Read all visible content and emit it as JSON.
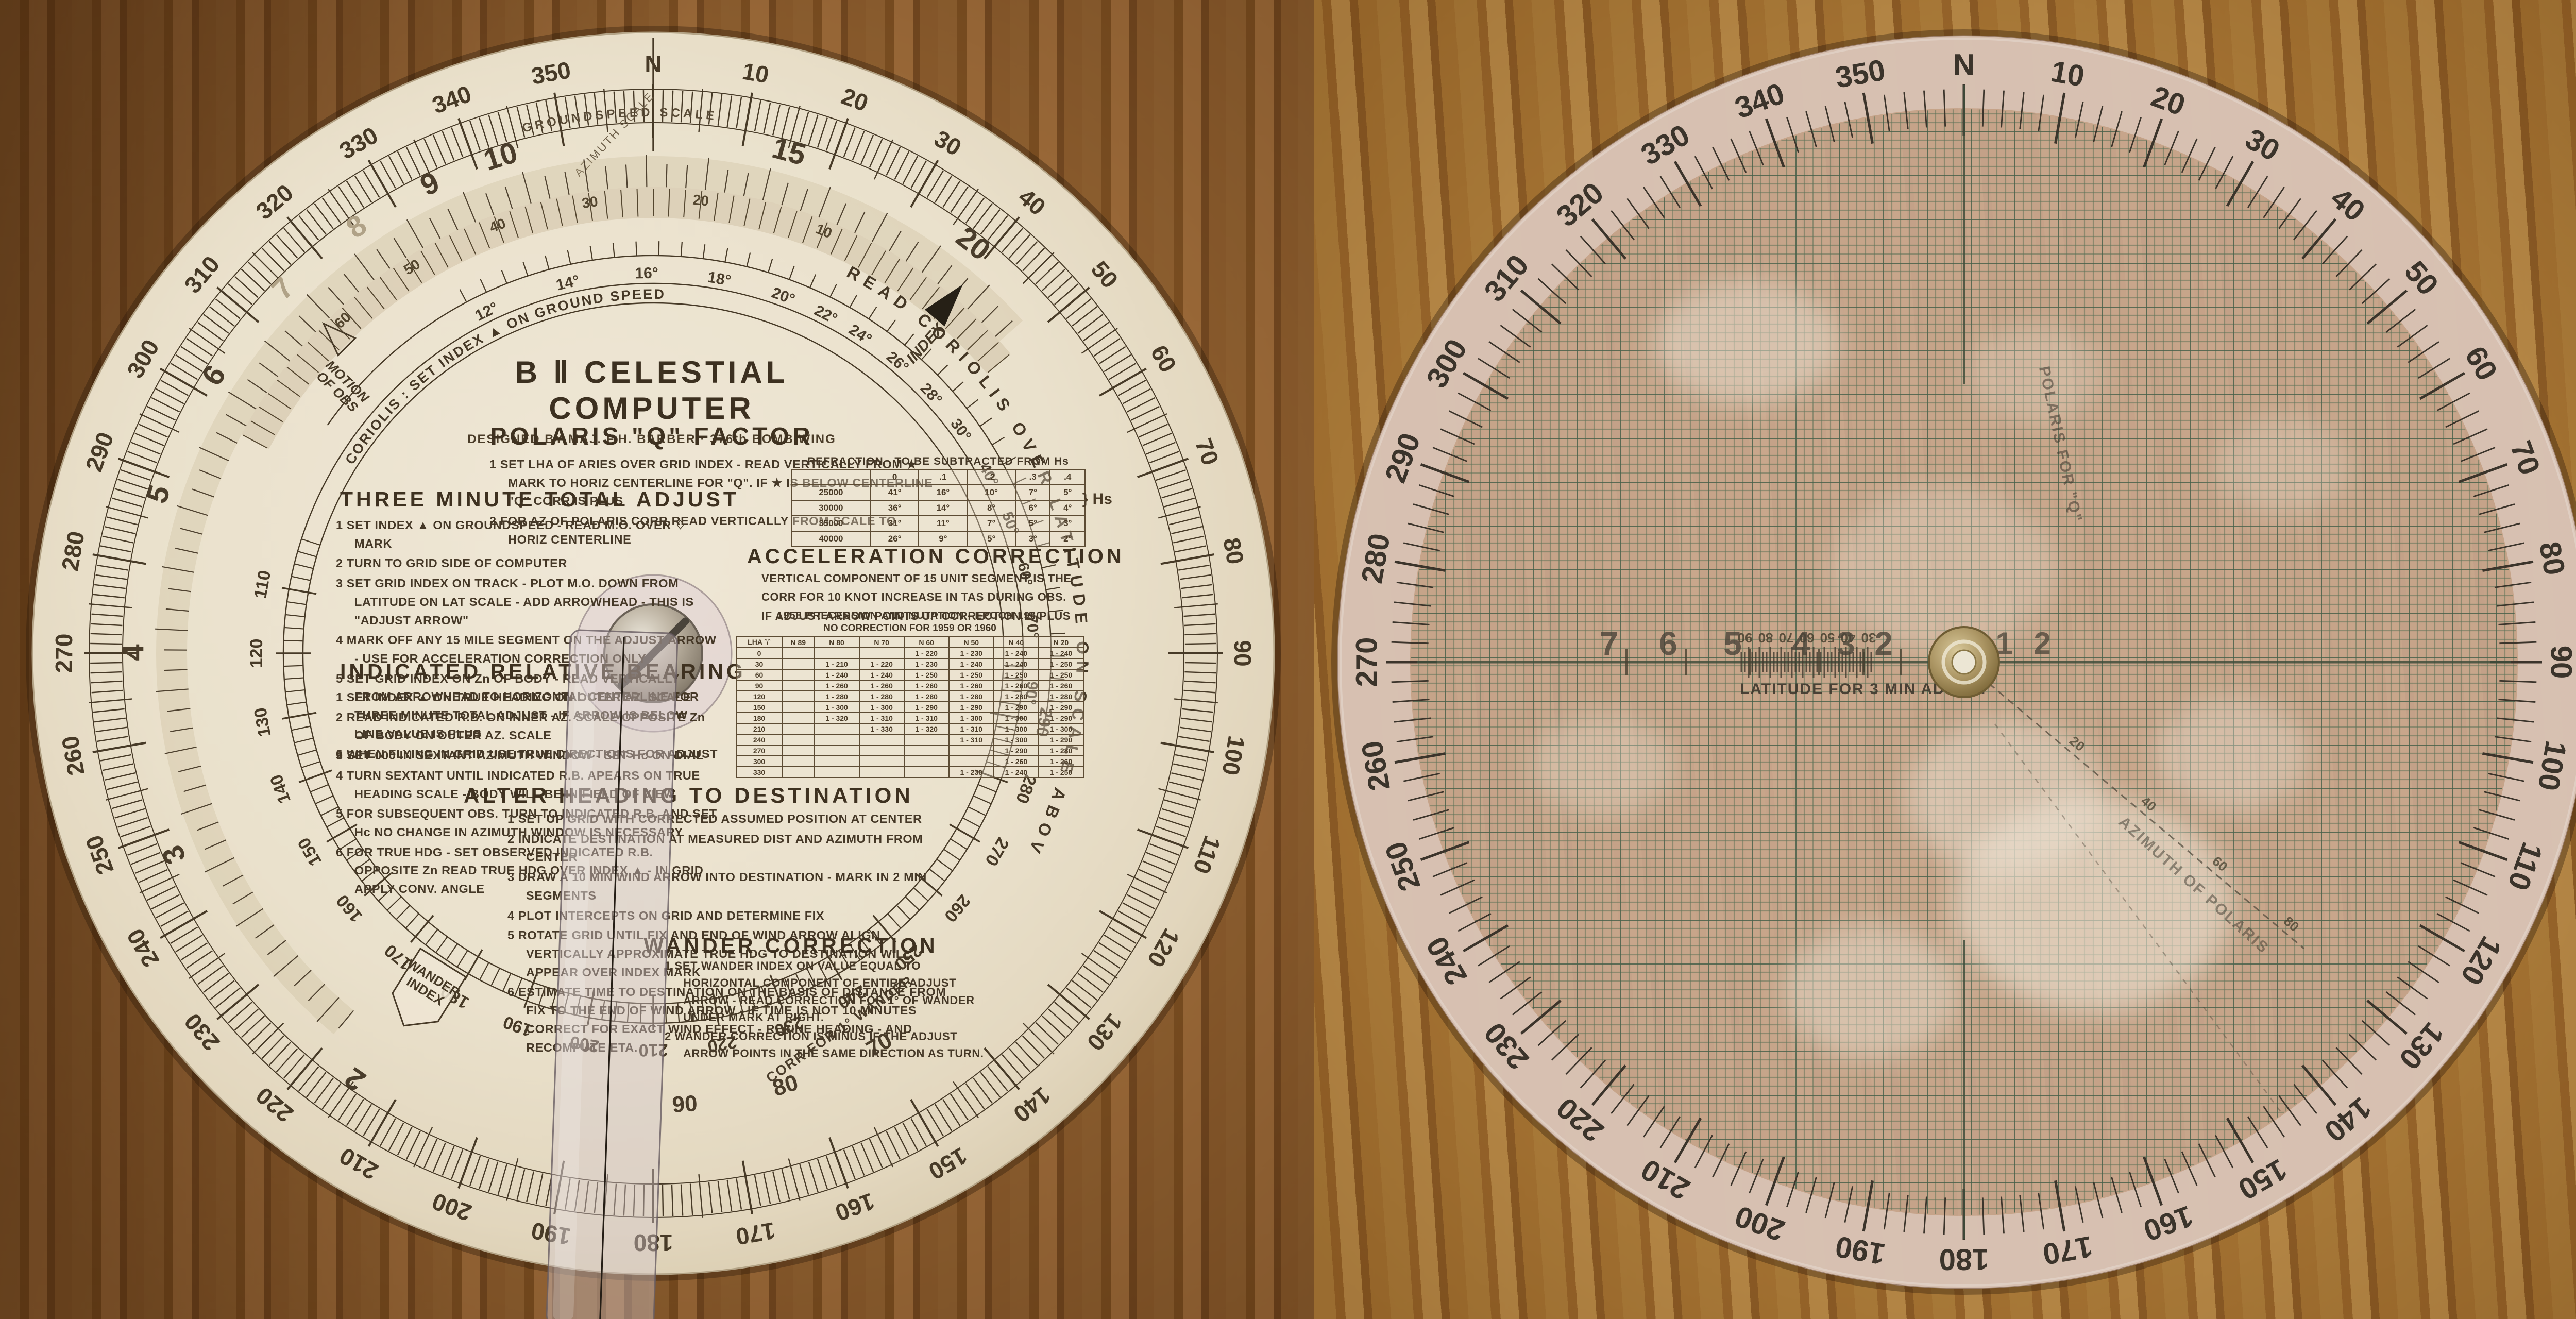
{
  "left_disc": {
    "title": "B Ⅱ  CELESTIAL  COMPUTER",
    "subtitle": "DESIGNED BY MAJ. F.H. BARBER   ·   376th BOMB WING",
    "azimuth_scale_label": "AZIMUTH SCALE",
    "outer_ring_labels": [
      "N",
      "10",
      "20",
      "30",
      "40",
      "50",
      "60",
      "70",
      "80",
      "90",
      "100",
      "110",
      "120",
      "130",
      "140",
      "150",
      "160",
      "170",
      "180",
      "190",
      "200",
      "210",
      "220",
      "230",
      "240",
      "250",
      "260",
      "270",
      "280",
      "290",
      "300",
      "310",
      "320",
      "330",
      "340",
      "350"
    ],
    "inner_ring_labels": [
      "290",
      "280",
      "270",
      "260",
      "250",
      "240",
      "230",
      "220",
      "210",
      "200",
      "190",
      "180",
      "170",
      "160",
      "150",
      "140",
      "130",
      "120",
      "110"
    ],
    "groundspeed": {
      "title": "GROUNDSPEED  SCALE",
      "values": [
        "2",
        "3",
        "4",
        "5",
        "6",
        "7",
        "8",
        "9",
        "10",
        "15",
        "20"
      ],
      "faint": [
        "7",
        "8"
      ]
    },
    "coriolis_minor_values": [
      "60",
      "50",
      "40",
      "30",
      "20",
      "10"
    ],
    "coriolis_arc_text_left": "CORIOLIS :    SET   INDEX   ▲   ON   GROUND SPEED",
    "coriolis_arc_text_right": "READ   CORIOLIS   OVER   LATITUDE   ON   SCALE   ABOVE",
    "latitude_labels": [
      "12°",
      "14°",
      "16°",
      "18°",
      "20°",
      "22°",
      "24°",
      "26°",
      "28°",
      "30°",
      "40°",
      "50°",
      "60°",
      "70°",
      "90°"
    ],
    "motion_of_obs_label": "MOTION\nOF OBS",
    "index_label": "INDEX",
    "corr_wander_text": "CORR  FOR  1°  WANDER",
    "wander_scale": [
      "70",
      "80",
      "90"
    ],
    "wander_index_tag": "WANDER\nINDEX",
    "sections": {
      "polaris": {
        "heading": "POLARIS  \"Q\"  FACTOR",
        "items": [
          "1  SET LHA OF ARIES OVER GRID INDEX - READ VERTICALLY FROM ★ MARK TO HORIZ CENTERLINE FOR \"Q\".  IF ★ IS BELOW CENTERLINE \"Q\" CORR IS PLUS",
          "2  FOR AZ OF POLARIS CORR READ VERTICALLY FROM SCALE TO HORIZ CENTERLINE"
        ]
      },
      "three_minute": {
        "heading": "THREE MINUTE TOTAL ADJUST",
        "items": [
          "1  SET INDEX ▲ ON GROUNDSPEED - READ M.O. OVER ♢ MARK",
          "2  TURN TO GRID SIDE OF COMPUTER",
          "3  SET GRID INDEX ON TRACK - PLOT M.O. DOWN FROM LATITUDE ON LAT SCALE - ADD ARROWHEAD - THIS IS \"ADJUST ARROW\"",
          "4  MARK OFF ANY 15 MILE SEGMENT ON THE ADJUST ARROW - USE FOR ACCELERATION CORRECTION ONLY",
          "5  SET GRID INDEX ON Zn OF BODY - READ VERTICALLY FROM ARROWHEAD TO HORIZONTAL CENTERLINE FOR THREE MINUTE TOTAL ADJUST - IF ARROW IS BELOW LINE VALUE IS PLUS",
          "6  WHEN FLYING IN GRID USE TRUE DIRECTIONS FOR ADJUST"
        ]
      },
      "indicated": {
        "heading": "INDICATED  RELATIVE  BEARING",
        "items": [
          "1  SET INDEX ▲ ON TRUE HEADING ON OUTER AZ. SCALE",
          "2  READ INDICATED R.B. ON INNER AZ. SCALE OPPOSITE Zn OF BODY ON OUTER AZ. SCALE",
          "3  SET 000 IN SEXTANT AZIMUTH WINDOW - SET Hc ON DIAL",
          "4  TURN SEXTANT UNTIL INDICATED R.B. APEARS ON TRUE HEADING SCALE - BODY WILL BE IN FIELD OF VIEW",
          "5  FOR SUBSEQUENT OBS. TURN TO INDICATED R.B. AND SET Hc NO CHANGE IN AZIMUTH WINDOW IS NECESSARY",
          "6  FOR TRUE HDG - SET OBSERVED INDICATED R.B. OPPOSITE Zn READ TRUE HDG OVER INDEX ▲ - IN GRID APPLY CONV. ANGLE"
        ]
      },
      "acceleration": {
        "heading": "ACCELERATION  CORRECTION",
        "items": [
          "VERTICAL COMPONENT OF 15 UNIT SEGMENT IS THE",
          "CORR FOR 10 KNOT INCREASE IN TAS DURING OBS.",
          "IF ADJUST ARROW POINTS UP CORRECTION IS PLUS"
        ]
      },
      "alter": {
        "heading": "ALTER HEADING TO DESTINATION",
        "items": [
          "1  SET UP GRID WITH CORRECTED ASSUMED POSITION AT CENTER",
          "2  INDICATE DESTINATION AT MEASURED DIST AND AZIMUTH FROM CENTER",
          "3  DRAW A 10 MIN WIND ARROW INTO DESTINATION - MARK IN 2 MIN SEGMENTS",
          "4  PLOT INTERCEPTS ON GRID AND DETERMINE FIX",
          "5  ROTATE GRID UNTIL FIX AND END OF WIND ARROW ALIGN VERTICALLY APPROXIMATE TRUE HDG TO DESTINATION WILL APPEAR OVER INDEX MARK",
          "6  ESTIMATE TIME TO DESTINATION ON THE BASIS OF DISTANCE FROM FIX TO THE END OF WIND ARROW - IF TIME IS NOT 10 MINUTES CORRECT FOR EXACT WIND EFFECT - REFINE HEADING - AND RECOMPUTE ETA."
        ]
      },
      "wander": {
        "heading": "WANDER  CORRECTION",
        "items": [
          "1  SET WANDER INDEX ON VALUE EQUAL TO HORIZONTAL COMPONENT OF ENTIRE ADJUST ARROW - READ CORRECTION FOR 1° OF WANDER UNDER MARK AT RIGHT.",
          "2  WANDER CORRECTION IS MINUS IF THE ADJUST ARROW POINTS IN THE SAME DIRECTION AS TURN."
        ]
      }
    },
    "refraction_table": {
      "title": "REFRACTION   ·   TO BE SUBTRACTED FROM Hs",
      "col_headers": [
        "",
        "0",
        ".1",
        ".2",
        ".3",
        ".4"
      ],
      "rows": [
        [
          "25000",
          "41°",
          "16°",
          "10°",
          "7°",
          "5°"
        ],
        [
          "30000",
          "36°",
          "14°",
          "8°",
          "6°",
          "4°"
        ],
        [
          "35000",
          "31°",
          "11°",
          "7°",
          "5°",
          "3°"
        ],
        [
          "40000",
          "26°",
          "9°",
          "5°",
          "3°",
          "2°"
        ]
      ],
      "hs_label": "Hs"
    },
    "precession_table": {
      "title": "1958 PRECESSION AND NUTATION   -   EPOCH 1960",
      "subtitle": "NO CORRECTION FOR 1959 OR 1960",
      "col_headers": [
        "LHA ♈",
        "N 89",
        "N 80",
        "N 70",
        "N 60",
        "N 50",
        "N 40",
        "N 20"
      ],
      "rows": [
        [
          "0",
          "",
          "",
          "",
          "1 - 220",
          "1 - 230",
          "1 - 240",
          "1 - 240"
        ],
        [
          "30",
          "",
          "1 - 210",
          "1 - 220",
          "1 - 230",
          "1 - 240",
          "1 - 240",
          "1 - 250"
        ],
        [
          "60",
          "",
          "1 - 240",
          "1 - 240",
          "1 - 250",
          "1 - 250",
          "1 - 250",
          "1 - 250"
        ],
        [
          "90",
          "",
          "1 - 260",
          "1 - 260",
          "1 - 260",
          "1 - 260",
          "1 - 260",
          "1 - 260"
        ],
        [
          "120",
          "",
          "1 - 280",
          "1 - 280",
          "1 - 280",
          "1 - 280",
          "1 - 280",
          "1 - 280"
        ],
        [
          "150",
          "",
          "1 - 300",
          "1 - 300",
          "1 - 290",
          "1 - 290",
          "1 - 290",
          "1 - 290"
        ],
        [
          "180",
          "",
          "1 - 320",
          "1 - 310",
          "1 - 310",
          "1 - 300",
          "1 - 300",
          "1 - 290"
        ],
        [
          "210",
          "",
          "",
          "1 - 330",
          "1 - 320",
          "1 - 310",
          "1 - 300",
          "1 - 300"
        ],
        [
          "240",
          "",
          "",
          "",
          "",
          "1 - 310",
          "1 - 300",
          "1 - 290"
        ],
        [
          "270",
          "",
          "",
          "",
          "",
          "",
          "1 - 290",
          "1 - 280"
        ],
        [
          "300",
          "",
          "",
          "",
          "",
          "",
          "1 - 260",
          "1 - 260"
        ],
        [
          "330",
          "",
          "",
          "",
          "",
          "1 - 230",
          "1 - 240",
          "1 - 250"
        ]
      ]
    }
  },
  "right_disc": {
    "ring_labels": [
      "N",
      "10",
      "20",
      "30",
      "40",
      "50",
      "60",
      "70",
      "80",
      "90",
      "100",
      "110",
      "120",
      "130",
      "140",
      "150",
      "160",
      "170",
      "180",
      "190",
      "200",
      "210",
      "220",
      "230",
      "240",
      "250",
      "260",
      "270",
      "280",
      "290",
      "300",
      "310",
      "320",
      "330",
      "340",
      "350"
    ],
    "horizontal_scale": {
      "left_values": [
        "7",
        "6",
        "5",
        "4",
        "3",
        "2"
      ],
      "right_values": [
        "1",
        "2"
      ],
      "latitude_cluster": [
        "90",
        "80",
        "70",
        "60",
        "50",
        "40",
        "30"
      ]
    },
    "latitude_caption": "LATITUDE  FOR  3 MIN  ADJUST",
    "diagonal_scale_values": [
      "20",
      "40",
      "60",
      "80"
    ],
    "diagonal_text_q": "POLARIS  FOR  \"Q\"",
    "diagonal_text_az": "AZIMUTH  OF  POLARIS"
  },
  "colors": {
    "ink": "#443726",
    "cream": "#eae1cc",
    "cream_edge": "#dccfb2",
    "grid_green_minor": "#5f7358",
    "grid_green_major": "#48604a",
    "plastic_pink": "#c9a892",
    "rim_pink": "#d8c2b3",
    "brass": "#b9a573",
    "wood_left": "#96602c",
    "wood_right": "#b87f35"
  }
}
